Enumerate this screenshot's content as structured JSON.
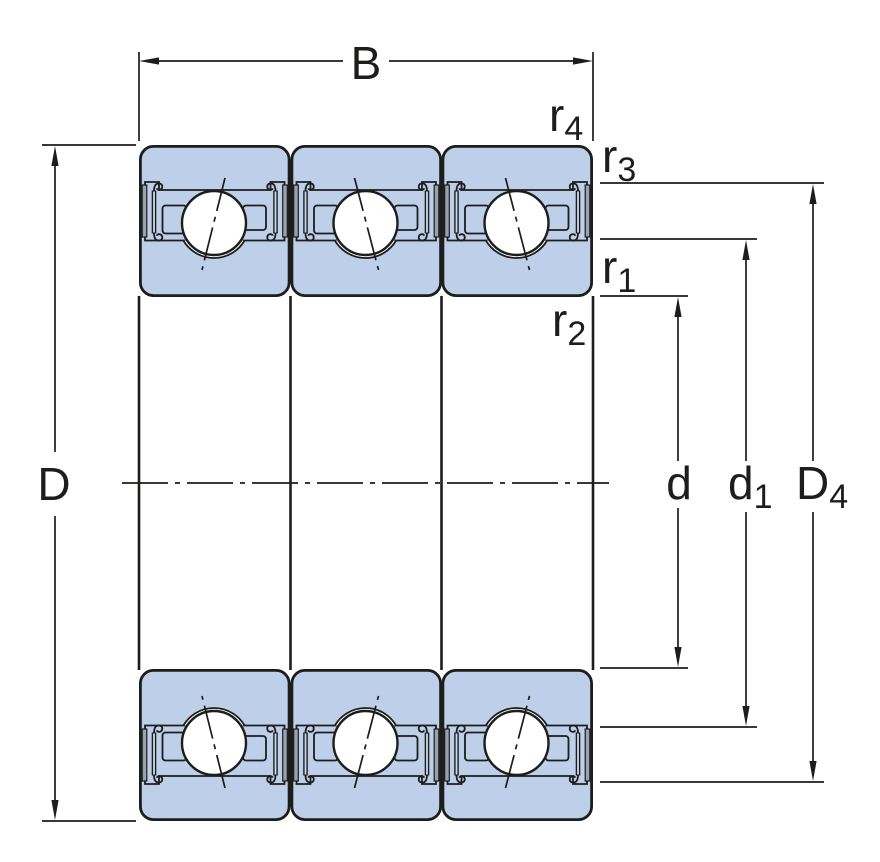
{
  "figure": {
    "type": "bearing-unit-cross-section",
    "rows": 2,
    "bearing_sections_per_row": 3,
    "balls_visible": 6
  },
  "labels": {
    "B": {
      "main": "B"
    },
    "D": {
      "main": "D"
    },
    "d": {
      "main": "d"
    },
    "d1": {
      "main": "d",
      "sub": "1"
    },
    "D4": {
      "main": "D",
      "sub": "4"
    },
    "r1": {
      "main": "r",
      "sub": "1"
    },
    "r2": {
      "main": "r",
      "sub": "2"
    },
    "r3": {
      "main": "r",
      "sub": "3"
    },
    "r4": {
      "main": "r",
      "sub": "4"
    }
  },
  "colors": {
    "bearing_fill": "#bdcfe9",
    "line": "#1d1d1b",
    "seal_insert_gray": "#98a3b0",
    "ball_fill": "#ffffff",
    "background": "#ffffff"
  }
}
